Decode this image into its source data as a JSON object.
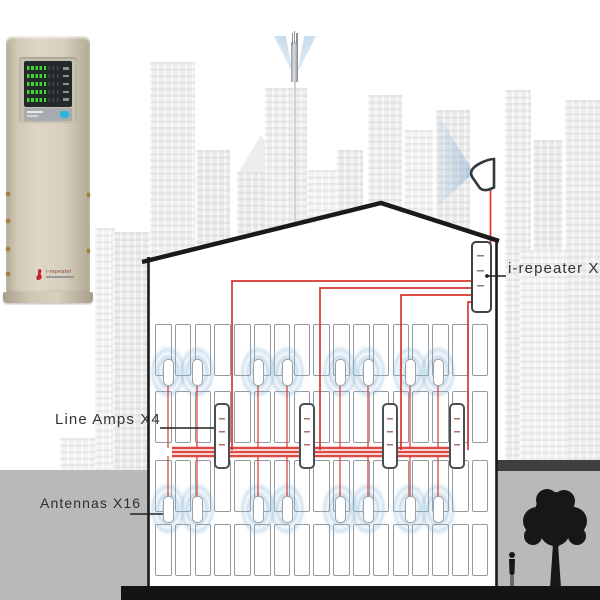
{
  "labels": {
    "repeater": "i-repeater X1",
    "line_amps": "Line Amps X4",
    "antennas": "Antennas X16"
  },
  "device": {
    "logo_text": "i-repeater",
    "display_rows": 5
  },
  "colors": {
    "cable_red": "#d8362f",
    "halo_blue": "#7fadd1",
    "ground_gray": "#b9b9b9",
    "ground_dark": "#3f3f3f",
    "outline_black": "#1a1a1a",
    "device_beige": "#d6cebd",
    "led_green": "#49d43f",
    "led_cyan": "#29b6d8"
  },
  "diagram": {
    "counts": {
      "repeaters": 1,
      "line_amps": 4,
      "antennas": 16
    },
    "window_grid": {
      "x0": 155,
      "col_pitch": 19.8,
      "col_width": 16.6,
      "cols": 17,
      "rows_y": [
        324,
        391,
        460,
        524
      ],
      "row_height": 52
    },
    "antenna_x": [
      168,
      197,
      258,
      287,
      340,
      368,
      410,
      438
    ],
    "antenna_y": {
      "upper_unit": 359,
      "lower_unit": 496,
      "upper_halo": 333,
      "lower_halo": 470
    },
    "amp_x": [
      222,
      307,
      390,
      457
    ],
    "amp_y": 403,
    "band_y": {
      "feed_top": 448,
      "feed_bottom": 456,
      "up_to": 386,
      "down_to": 500
    },
    "cable_paths": [
      "M472 281 H232 V450",
      "M472 288 H320 V450",
      "M472 295 H401 V450",
      "M472 302 H468 V450",
      "M490.5 186 V300",
      "M172 448 H462",
      "M172 452 H462",
      "M172 456 H462"
    ]
  }
}
